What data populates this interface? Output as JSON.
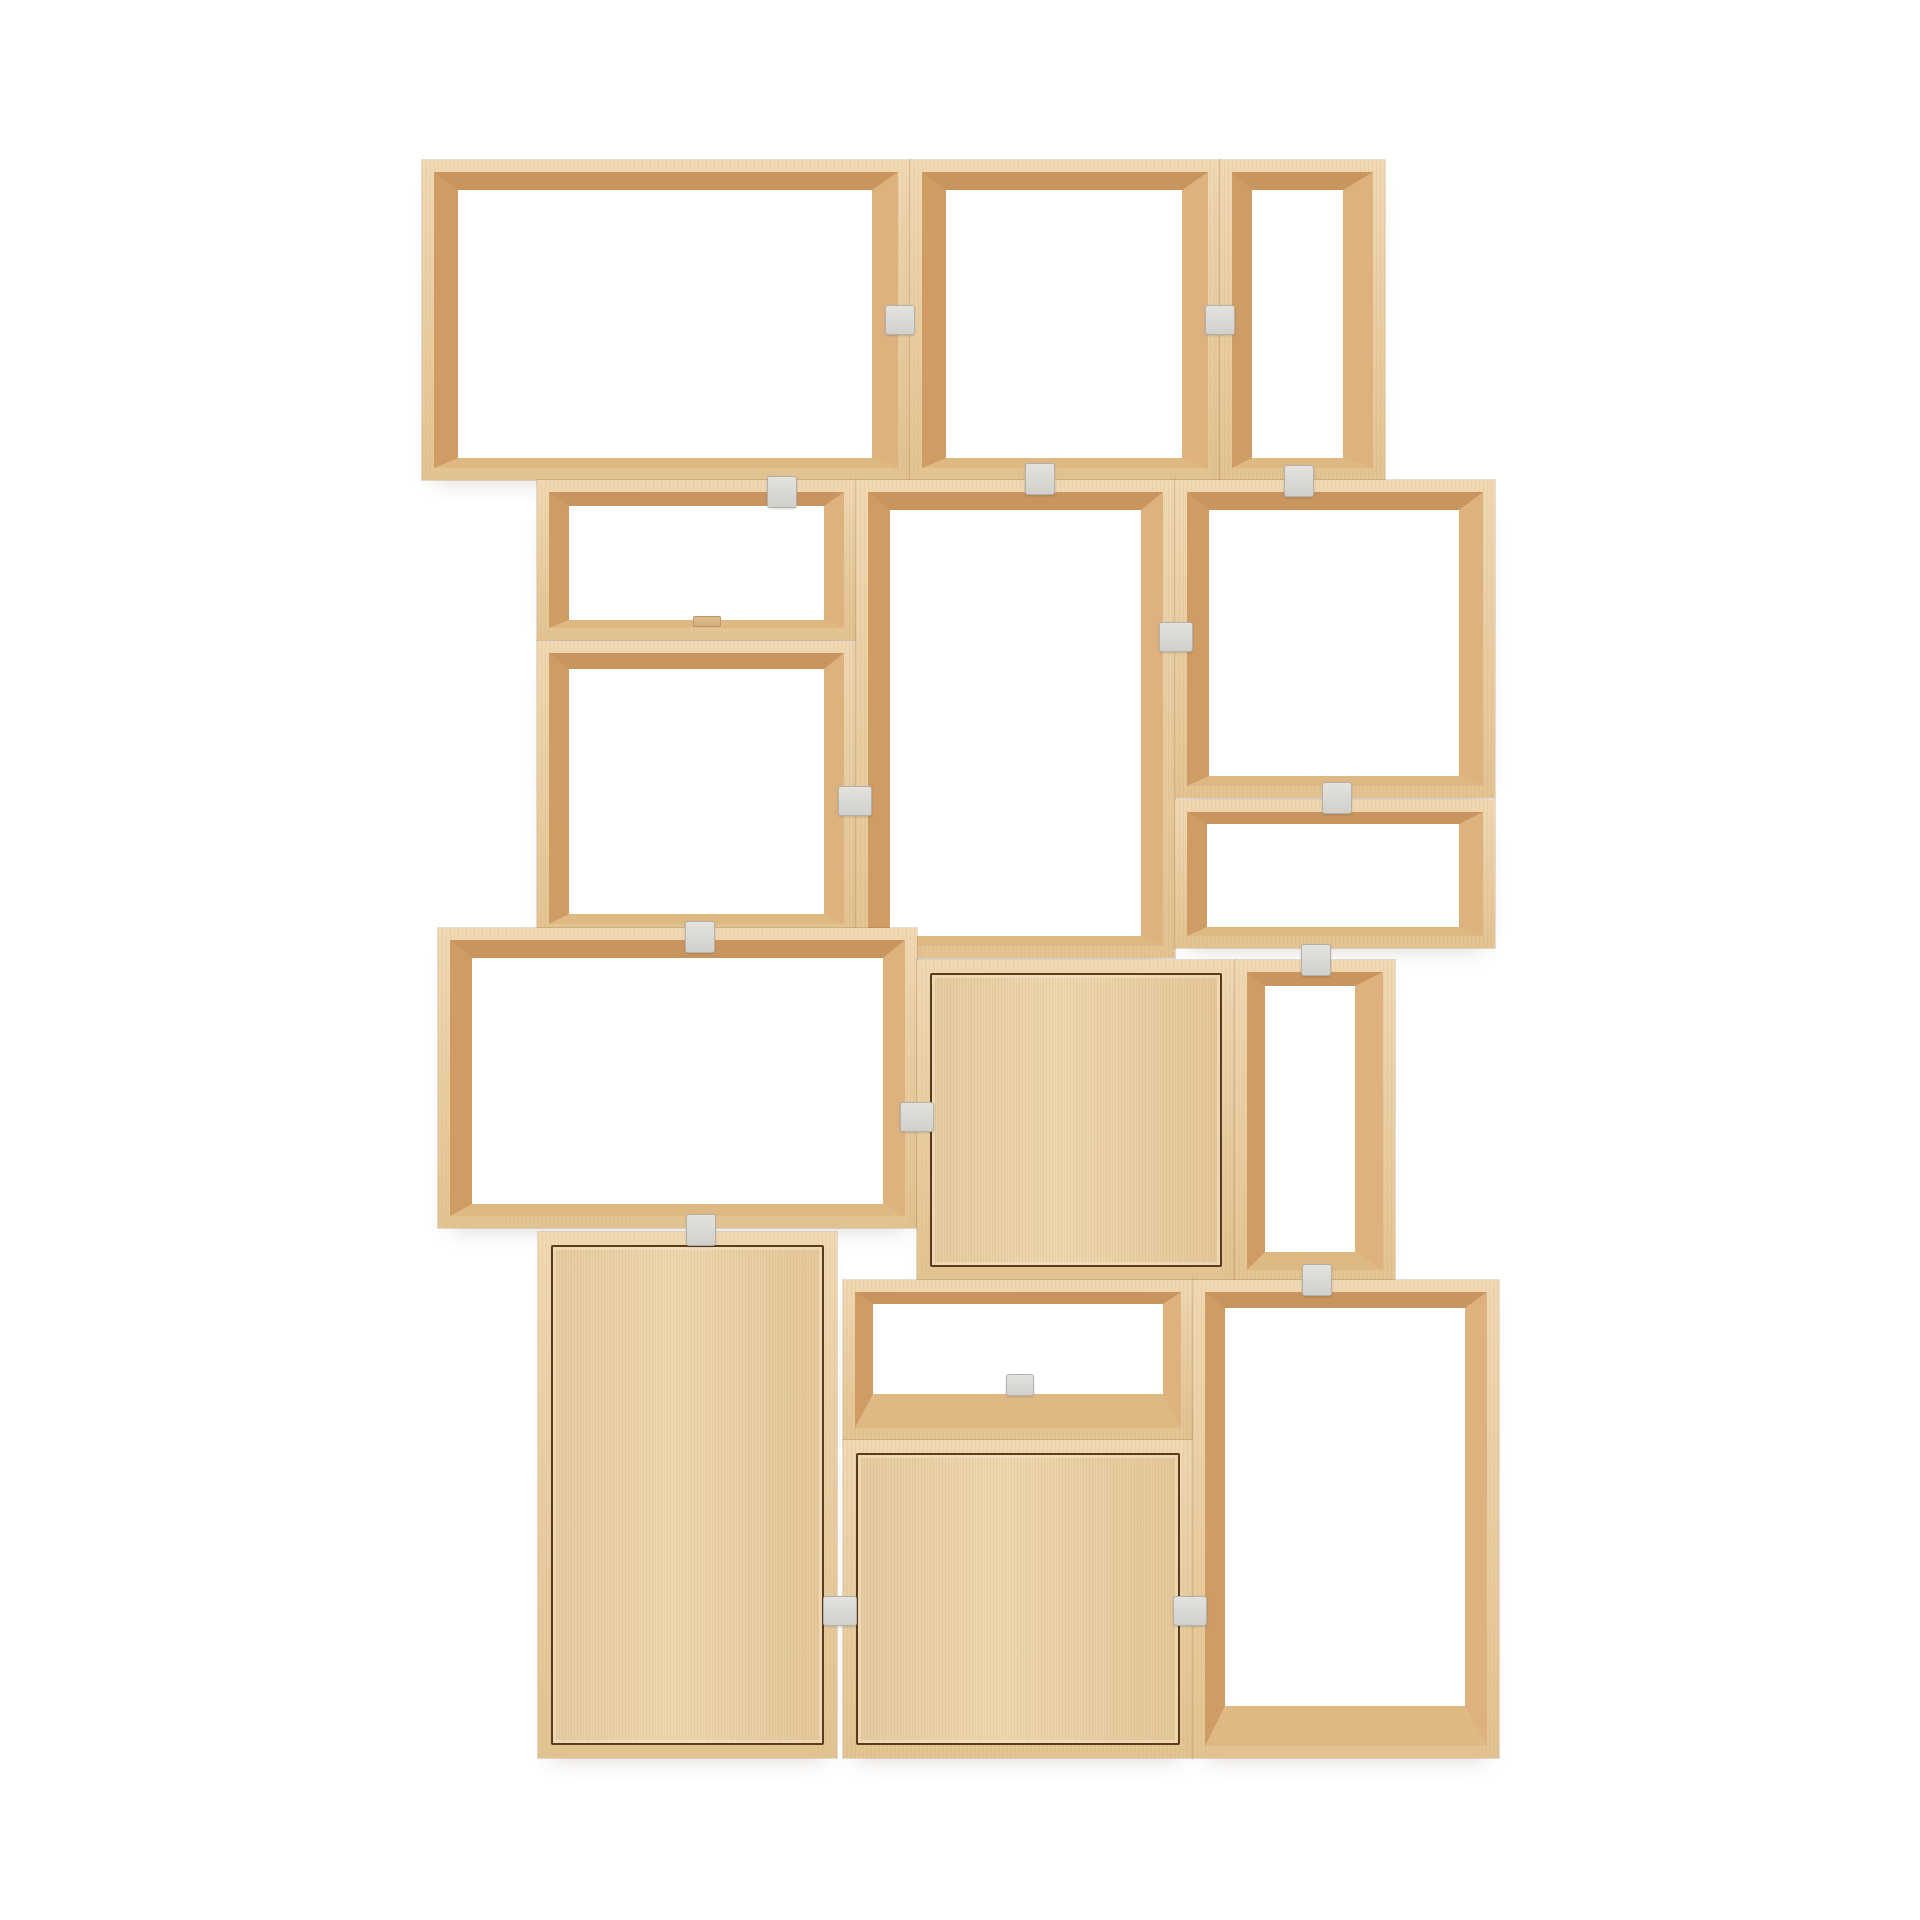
{
  "scene": {
    "description": "Product photo of a light-oak modular stacked shelving system on a white background: fifteen stacked box modules (open frames and three door cabinets) joined by small grey connector clips",
    "background": "#ffffff",
    "canvas": {
      "width": 1920,
      "height": 1920
    }
  },
  "palette": {
    "wood_face_light": "#f0d8b2",
    "wood_face_dark": "#e3c392",
    "shade_inner_top": "#c9955e",
    "shade_inner_left": "#cf9c64",
    "shade_inner_right": "#ddb27e",
    "shade_inner_bottom": "#dfb984",
    "door_panel": "#e9d0a8",
    "door_outline": "#5a3b1b",
    "clip_fill": "#dcdad5",
    "clip_border": "#b3b1ab",
    "background": "#ffffff"
  },
  "modules": [
    {
      "name": "open-box-top-left",
      "type": "open",
      "x": 422,
      "y": 160,
      "w": 488,
      "h": 320,
      "inset": [
        18,
        24,
        26,
        10
      ]
    },
    {
      "name": "open-box-top-middle",
      "type": "open",
      "x": 910,
      "y": 160,
      "w": 310,
      "h": 320,
      "inset": [
        18,
        24,
        26,
        10
      ]
    },
    {
      "name": "open-box-top-right",
      "type": "open",
      "x": 1220,
      "y": 160,
      "w": 165,
      "h": 320,
      "inset": [
        18,
        20,
        30,
        10
      ]
    },
    {
      "name": "open-box-row2-left-upper",
      "type": "open",
      "x": 537,
      "y": 480,
      "w": 319,
      "h": 160,
      "inset": [
        14,
        20,
        20,
        8
      ]
    },
    {
      "name": "open-box-row2-left-lower",
      "type": "open",
      "x": 537,
      "y": 641,
      "w": 319,
      "h": 295,
      "inset": [
        16,
        20,
        20,
        10
      ]
    },
    {
      "name": "open-box-row2-middle",
      "type": "open",
      "x": 856,
      "y": 480,
      "w": 319,
      "h": 478,
      "inset": [
        18,
        22,
        22,
        10
      ]
    },
    {
      "name": "open-box-row2-right-upper",
      "type": "open",
      "x": 1175,
      "y": 480,
      "w": 320,
      "h": 318,
      "inset": [
        18,
        22,
        24,
        10
      ]
    },
    {
      "name": "open-box-row2-right-lower",
      "type": "open",
      "x": 1175,
      "y": 800,
      "w": 320,
      "h": 148,
      "inset": [
        12,
        20,
        24,
        9
      ]
    },
    {
      "name": "open-box-row3-left",
      "type": "open",
      "x": 438,
      "y": 928,
      "w": 479,
      "h": 300,
      "inset": [
        18,
        22,
        22,
        12
      ]
    },
    {
      "name": "door-box-row3-middle",
      "type": "door",
      "x": 917,
      "y": 960,
      "w": 318,
      "h": 320
    },
    {
      "name": "open-box-row3-right",
      "type": "open",
      "x": 1235,
      "y": 960,
      "w": 160,
      "h": 322,
      "inset": [
        14,
        18,
        28,
        18
      ]
    },
    {
      "name": "door-box-row4-left",
      "type": "door",
      "x": 538,
      "y": 1232,
      "w": 299,
      "h": 526
    },
    {
      "name": "open-box-row4-middle",
      "type": "open",
      "x": 843,
      "y": 1280,
      "w": 350,
      "h": 160,
      "inset": [
        12,
        18,
        18,
        34
      ]
    },
    {
      "name": "door-box-row4-middle",
      "type": "door",
      "x": 843,
      "y": 1440,
      "w": 350,
      "h": 318
    },
    {
      "name": "open-box-row4-right",
      "type": "open",
      "x": 1193,
      "y": 1280,
      "w": 306,
      "h": 478,
      "inset": [
        16,
        20,
        22,
        40
      ]
    }
  ],
  "clips": [
    {
      "x": 885,
      "y": 305,
      "w": 30,
      "h": 30,
      "variant": "grey"
    },
    {
      "x": 1205,
      "y": 305,
      "w": 30,
      "h": 30,
      "variant": "grey"
    },
    {
      "x": 767,
      "y": 476,
      "w": 30,
      "h": 32,
      "variant": "grey"
    },
    {
      "x": 1025,
      "y": 463,
      "w": 30,
      "h": 32,
      "variant": "grey"
    },
    {
      "x": 1284,
      "y": 465,
      "w": 30,
      "h": 32,
      "variant": "grey"
    },
    {
      "x": 838,
      "y": 786,
      "w": 34,
      "h": 30,
      "variant": "grey"
    },
    {
      "x": 1159,
      "y": 622,
      "w": 34,
      "h": 30,
      "variant": "grey"
    },
    {
      "x": 685,
      "y": 921,
      "w": 30,
      "h": 32,
      "variant": "grey"
    },
    {
      "x": 1322,
      "y": 782,
      "w": 30,
      "h": 32,
      "variant": "grey"
    },
    {
      "x": 1301,
      "y": 944,
      "w": 30,
      "h": 32,
      "variant": "grey"
    },
    {
      "x": 900,
      "y": 1102,
      "w": 34,
      "h": 30,
      "variant": "grey"
    },
    {
      "x": 686,
      "y": 1214,
      "w": 30,
      "h": 32,
      "variant": "grey"
    },
    {
      "x": 1302,
      "y": 1264,
      "w": 30,
      "h": 32,
      "variant": "grey"
    },
    {
      "x": 823,
      "y": 1596,
      "w": 34,
      "h": 30,
      "variant": "grey"
    },
    {
      "x": 1173,
      "y": 1596,
      "w": 34,
      "h": 30,
      "variant": "grey"
    },
    {
      "x": 1006,
      "y": 1374,
      "w": 28,
      "h": 22,
      "variant": "grey"
    },
    {
      "x": 693,
      "y": 616,
      "w": 28,
      "h": 11,
      "variant": "wood"
    }
  ]
}
